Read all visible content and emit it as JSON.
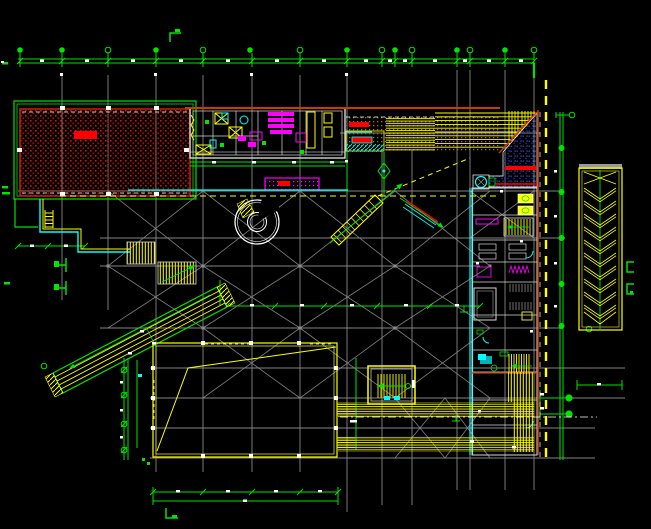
{
  "drawing": {
    "type": "cad-architectural-floor-plan",
    "background": "#000000",
    "notes": "no legible text labels; dimension strings render as unreadable white marks"
  },
  "palette": {
    "green": "#00e400",
    "gray": "#8c8c8c",
    "yellow": "#ffff00",
    "red": "#ff0000",
    "magenta": "#ff00ff",
    "cyan": "#00ffff",
    "white": "#ffffff",
    "orange": "#cd3a00",
    "khaki": "#a07800",
    "navy": "#2233cc",
    "wall_white": "#d8d8d8"
  },
  "layers": [
    {
      "name": "structural-grid",
      "color_key": "gray"
    },
    {
      "name": "dimensions-and-axes",
      "color_key": "green"
    },
    {
      "name": "hatched-hall",
      "color_key": "red"
    },
    {
      "name": "kitchen-service-block",
      "color_key": "wall_white"
    },
    {
      "name": "khaki-dotted-zone",
      "color_key": "khaki"
    },
    {
      "name": "terrace-steps",
      "color_key": "yellow"
    },
    {
      "name": "ramp-triangle",
      "color_key": "navy"
    },
    {
      "name": "right-room-column",
      "color_key": "wall_white"
    },
    {
      "name": "circulation-stairs-escalators",
      "color_key": "yellow"
    },
    {
      "name": "diagonal-wing",
      "color_key": "green"
    },
    {
      "name": "roof-rectangle",
      "color_key": "yellow"
    },
    {
      "name": "chevron-ramp",
      "color_key": "yellow"
    }
  ]
}
